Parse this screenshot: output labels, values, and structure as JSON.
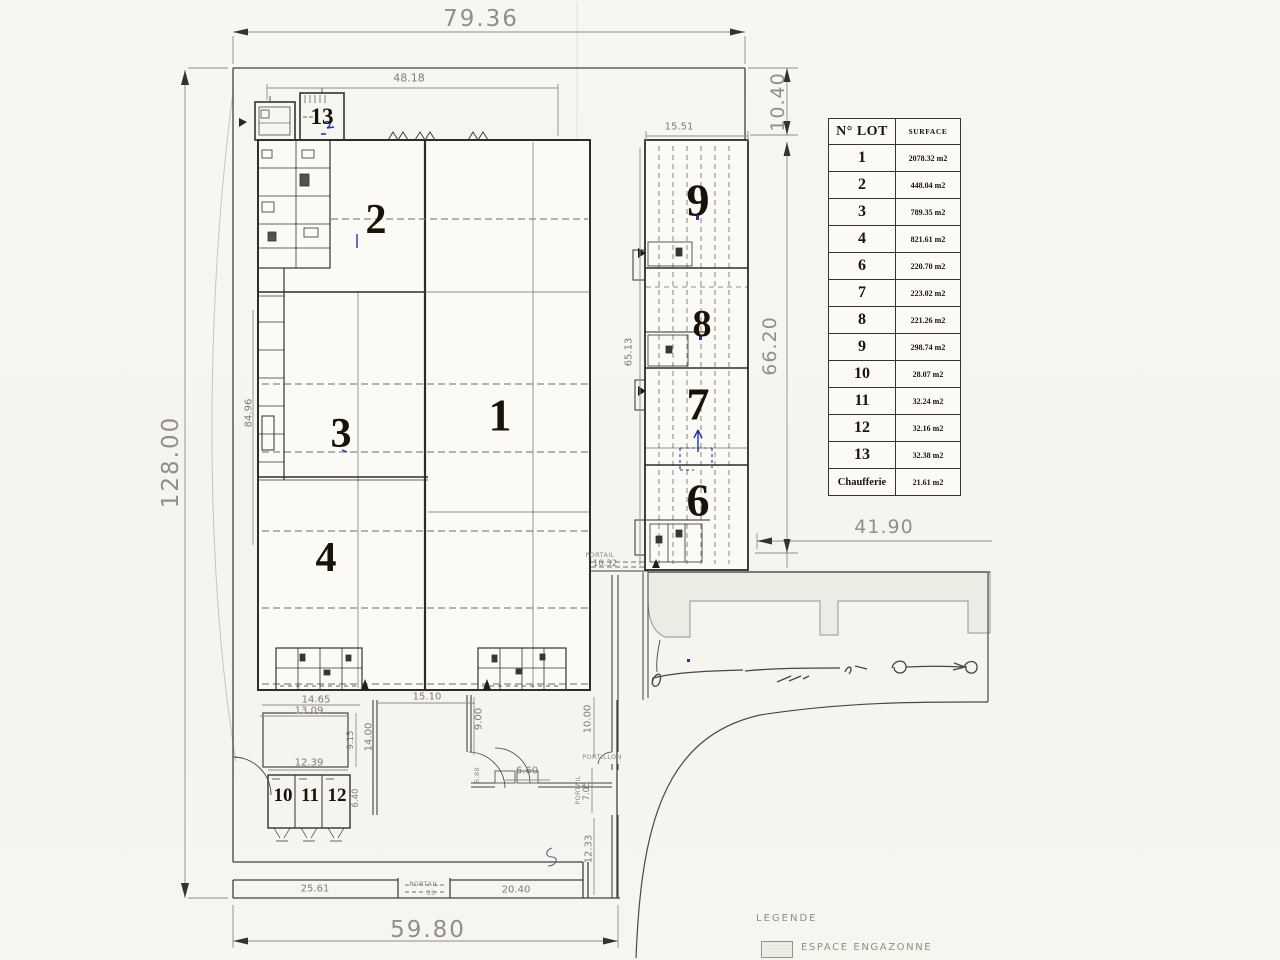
{
  "surface_table": {
    "col_lot": "N° LOT",
    "col_surface": "SURFACE",
    "rows": [
      {
        "lot": "1",
        "surface": "2078.32 m2"
      },
      {
        "lot": "2",
        "surface": "448.04 m2"
      },
      {
        "lot": "3",
        "surface": "789.35 m2"
      },
      {
        "lot": "4",
        "surface": "821.61 m2"
      },
      {
        "lot": "6",
        "surface": "220.70 m2"
      },
      {
        "lot": "7",
        "surface": "223.02 m2"
      },
      {
        "lot": "8",
        "surface": "221.26 m2"
      },
      {
        "lot": "9",
        "surface": "298.74 m2"
      },
      {
        "lot": "10",
        "surface": "28.07 m2"
      },
      {
        "lot": "11",
        "surface": "32.24 m2"
      },
      {
        "lot": "12",
        "surface": "32.16 m2"
      },
      {
        "lot": "13",
        "surface": "32.38 m2"
      },
      {
        "lot": "Chaufferie",
        "surface": "21.61 m2"
      }
    ]
  },
  "legend": {
    "title": "LEGENDE",
    "item_grass": "ESPACE ENGAZONNE"
  },
  "plan_lots": {
    "lot1": "1",
    "lot2": "2",
    "lot3": "3",
    "lot4": "4",
    "lot6": "6",
    "lot7": "7",
    "lot8": "8",
    "lot9": "9",
    "lot10": "10",
    "lot11": "11",
    "lot12": "12",
    "lot13": "13"
  },
  "dims": {
    "top_width": "79.36",
    "left_height": "128.00",
    "bottom_width": "59.80",
    "ne_setback": "10.40",
    "east_height": "66.20",
    "east_clearance": "41.90",
    "bldg_top": "48.18",
    "east_bldg_width": "15.51",
    "east_bldg_height": "65.13",
    "west_bldg_height": "84.96",
    "d14_65": "14.65",
    "d13_09": "13.09",
    "d15_10": "15.10",
    "d14_00": "14.00",
    "d9_15": "9.15",
    "d12_39": "12.39",
    "d6_40": "6.40",
    "d9_00": "9.00",
    "d10_00": "10.00",
    "d6_60": "6.60",
    "d5_80": "5.80",
    "d7_05": "7.05",
    "d12_33": "12.33",
    "d20_40": "20.40",
    "d25_61": "25.61",
    "d10_32": "10.32",
    "d0_35": "35",
    "portail": "PORTAIL",
    "portillon": "PORTILLON"
  },
  "colors": {
    "paper": "#f6f5f1",
    "line_dark": "#35322e",
    "line_mid": "#6e6b64",
    "dim_text": "#8b887e",
    "lot_text": "#181209",
    "blue_ink": "#2433a8",
    "grass_fill": "#edece4"
  }
}
